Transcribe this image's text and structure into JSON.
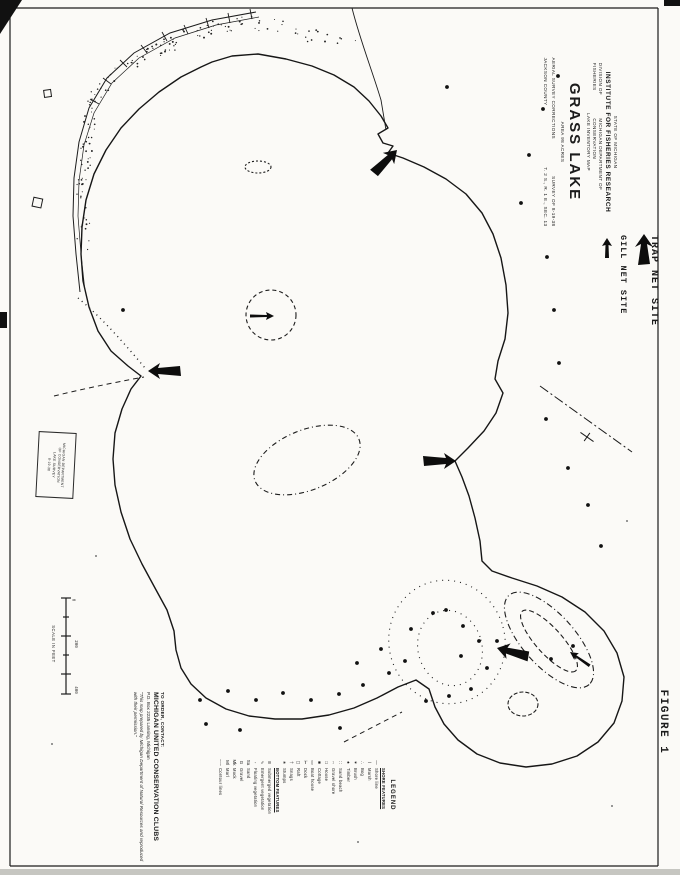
{
  "figure_label": "FIGURE 1",
  "title_block": {
    "dept": "STATE OF MICHIGAN",
    "institute": "INSTITUTE FOR FISHERIES RESEARCH",
    "division": "DIVISION OF FISHERIES",
    "dept2": "MICHIGAN DEPARTMENT OF CONSERVATION",
    "map_type": "LAKE INVENTORY MAP",
    "lake_name": "GRASS LAKE",
    "area": "AREA   98   ACRES",
    "survey_a": "AERIAL SURVEY CORRECTIONS",
    "survey_b": "SURVEY OF 8-19-38",
    "county": "JACKSON COUNTY",
    "township": "T. 2 S.,  R. 1 E.,  SEC. 13"
  },
  "site_key": {
    "trap_label": "TRAP NET SITE",
    "gill_label": "GILL NET SITE"
  },
  "legend": {
    "title": "LEGEND",
    "items": [
      {
        "symbol": "",
        "label": "SHORE FEATURES"
      },
      {
        "symbol": "—",
        "label": "Shore line"
      },
      {
        "symbol": "⌇",
        "label": "Marsh"
      },
      {
        "symbol": "∴",
        "label": "Bog"
      },
      {
        "symbol": "✶",
        "label": "Brush"
      },
      {
        "symbol": "♠",
        "label": "Timber"
      },
      {
        "symbol": "∷",
        "label": "Sand beach"
      },
      {
        "symbol": "◦◦",
        "label": "Gravel shore"
      },
      {
        "symbol": "□",
        "label": "House"
      },
      {
        "symbol": "■",
        "label": "Cottage"
      },
      {
        "symbol": "▭",
        "label": "Boat house"
      },
      {
        "symbol": "⊢",
        "label": "Dock"
      },
      {
        "symbol": "◻",
        "label": "Raft"
      },
      {
        "symbol": "†",
        "label": "Snags"
      },
      {
        "symbol": "∗",
        "label": "Stumps"
      },
      {
        "symbol": "",
        "label": "BOTTOM FEATURES"
      },
      {
        "symbol": "≋",
        "label": "Submerged vegetation"
      },
      {
        "symbol": "∿",
        "label": "Emergent vegetation"
      },
      {
        "symbol": "◦",
        "label": "Floating vegetation"
      },
      {
        "symbol": "Sa",
        "label": "Sand"
      },
      {
        "symbol": "G",
        "label": "Gravel"
      },
      {
        "symbol": "Mk",
        "label": "Muck"
      },
      {
        "symbol": "Ml",
        "label": "Marl"
      },
      {
        "symbol": "–·–",
        "label": "Contour lines"
      }
    ]
  },
  "order_block": {
    "line1": "TO ORDER, CONTACT:",
    "line2": "MICHIGAN UNITED CONSERVATION CLUBS",
    "line3": "P.O. Box 2235        Lansing, Michigan",
    "note": "\"This map prepared by Michigan Department of Natural Resources and reproduced with their permission.\""
  },
  "stamp": {
    "lines": [
      "MICHIGAN DEPARTMENT",
      "OF CONSERVATION",
      "LAKE SURVEY",
      "8-19-38"
    ]
  },
  "scale_bar": {
    "caption": "SCALE IN FEET",
    "labels": [
      "0",
      "200",
      "400"
    ]
  },
  "colors": {
    "ink": "#1b1b1b",
    "paper": "#fbfaf7"
  }
}
